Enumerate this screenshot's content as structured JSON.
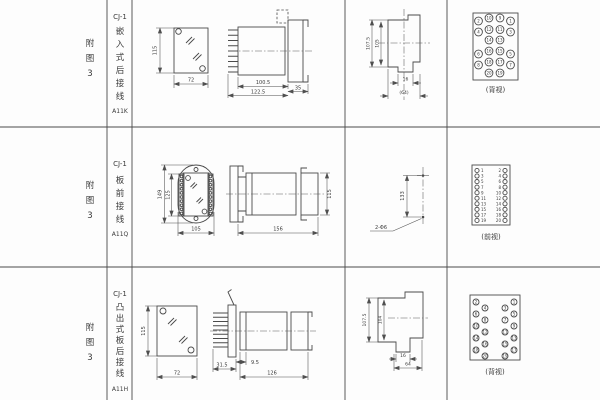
{
  "rows": [
    {
      "side_label": [
        "附",
        "图",
        "3"
      ],
      "model": "CJ-1",
      "type_chars": [
        "嵌",
        "入",
        "式",
        "后",
        "接",
        "线"
      ],
      "code": "A11K",
      "dims": {
        "panel_h": "115",
        "panel_w": "72",
        "body_len": "100.5",
        "total_len": "122.5",
        "flange": "35",
        "front_h_outer": "107.5",
        "front_h_inner": "105",
        "notch_w": "16",
        "width_ref": "(64)"
      },
      "terminal_caption": "(背视)",
      "terminals": [
        [
          "2",
          "10",
          "9",
          "1"
        ],
        [
          "4",
          "12",
          "11",
          "3"
        ],
        [
          "",
          "14",
          "13",
          ""
        ],
        [
          "6",
          "16",
          "15",
          "5"
        ],
        [
          "8",
          "18",
          "17",
          "7"
        ],
        [
          "",
          "20",
          "19",
          ""
        ]
      ]
    },
    {
      "side_label": [
        "附",
        "图",
        "3"
      ],
      "model": "CJ-1",
      "type_chars": [
        "板",
        "前",
        "接",
        "线"
      ],
      "code": "A11Q",
      "dims": {
        "outer_h": "149",
        "inner_h": "125",
        "width": "105",
        "side_len": "156",
        "side_h": "115",
        "hole_pitch": "133",
        "hole_note": "2-Φ6"
      },
      "terminal_caption": "(前视)",
      "terminals_left": [
        "1",
        "3",
        "5",
        "7",
        "9",
        "11",
        "13",
        "15",
        "17",
        "19"
      ],
      "terminals_right": [
        "2",
        "4",
        "6",
        "8",
        "10",
        "12",
        "14",
        "16",
        "18",
        "20"
      ]
    },
    {
      "side_label": [
        "附",
        "图",
        "3"
      ],
      "model": "CJ-1",
      "type_chars": [
        "凸",
        "出",
        "式",
        "板",
        "后",
        "接",
        "线"
      ],
      "code": "A11H",
      "dims": {
        "panel_h": "115",
        "panel_w": "72",
        "plate_off": "31.5",
        "pin_off": "9.5",
        "body_len": "126",
        "front_h_outer": "107.5",
        "front_h_inner": "104",
        "notch_w": "16",
        "width_ref": "64"
      },
      "terminal_caption": "(背视)",
      "terminals_left": [
        "2",
        "4",
        "6",
        "8",
        "10",
        "12",
        "14",
        "16",
        "18",
        "20"
      ],
      "terminals_right": [
        "1",
        "3",
        "5",
        "7",
        "9",
        "11",
        "13",
        "15",
        "17",
        "19"
      ]
    }
  ]
}
